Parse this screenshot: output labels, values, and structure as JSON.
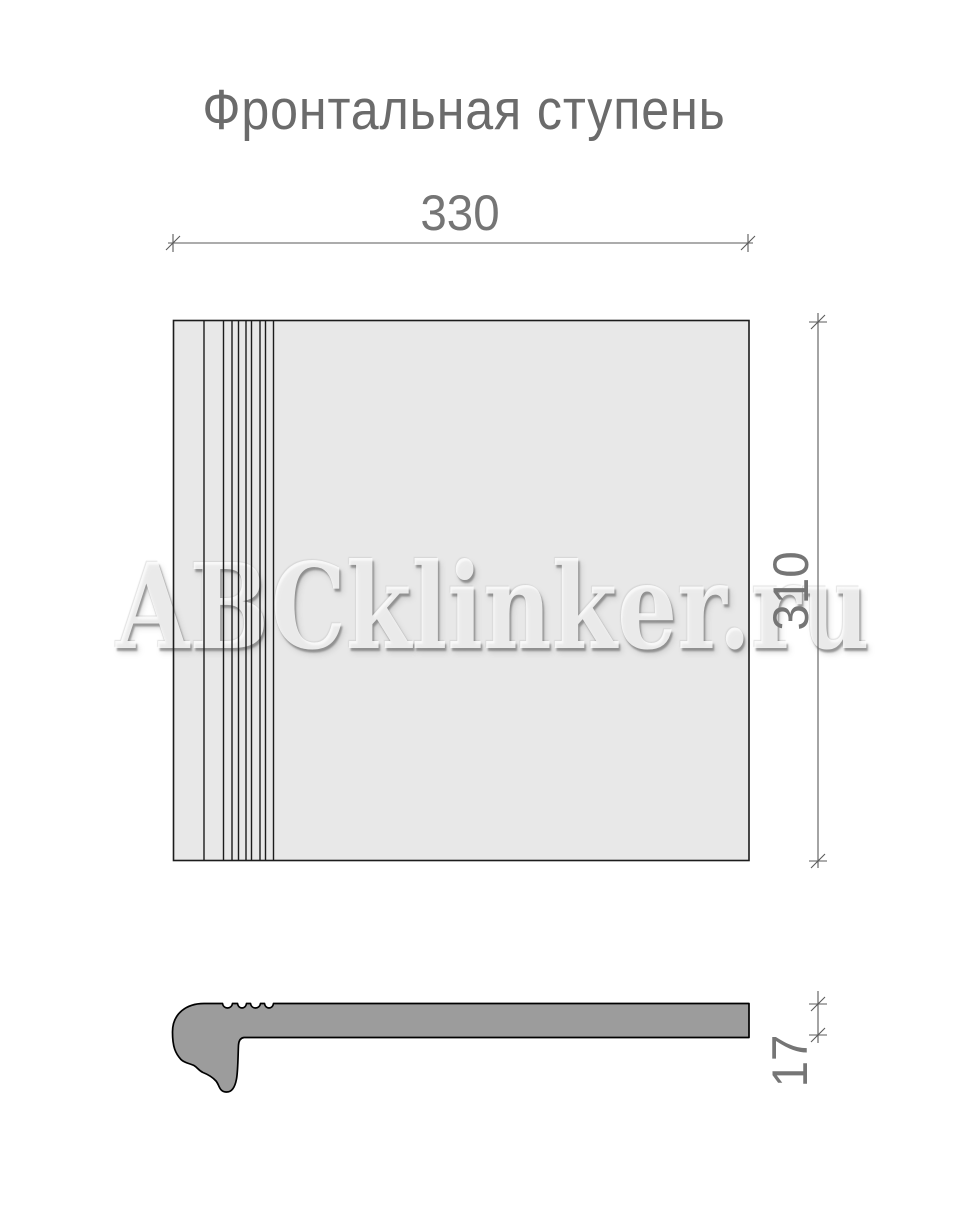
{
  "title": "Фронтальная ступень",
  "watermark": "ABCklinker.ru",
  "plan": {
    "width_label": "330",
    "depth_label": "310"
  },
  "section": {
    "thickness_label": "17"
  },
  "colors": {
    "tile_fill": "#e8e8e8",
    "section_fill": "#9c9c9c",
    "outline": "#1c1c1c",
    "dimension_line": "#5a5a5a",
    "dimension_text": "#757575",
    "title_text": "#6b6b6b"
  }
}
